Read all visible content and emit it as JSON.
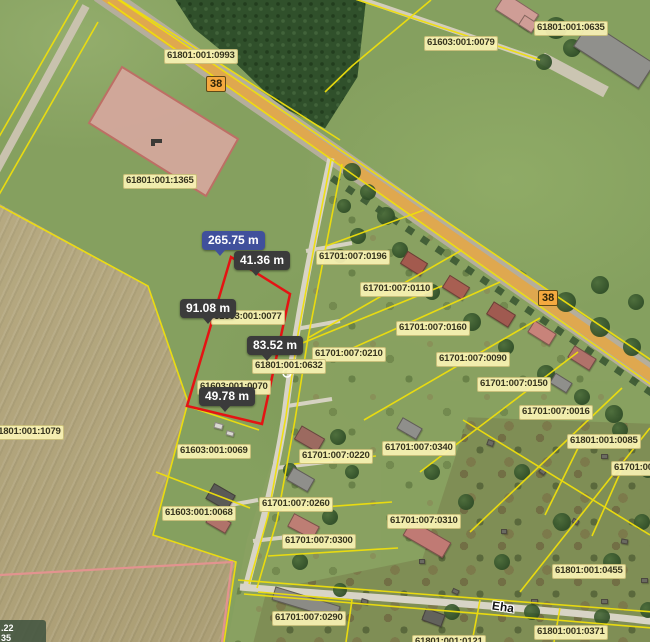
{
  "map": {
    "parcel_labels": [
      {
        "text": "61801:001:0993",
        "x": 164,
        "y": 49
      },
      {
        "text": "61603:001:0079",
        "x": 424,
        "y": 36
      },
      {
        "text": "61801:001:0635",
        "x": 534,
        "y": 21
      },
      {
        "text": "61801:001:1365",
        "x": 123,
        "y": 174
      },
      {
        "text": "61701:007:0196",
        "x": 316,
        "y": 250
      },
      {
        "text": "61701:007:0110",
        "x": 360,
        "y": 282
      },
      {
        "text": "61701:007:0160",
        "x": 396,
        "y": 321
      },
      {
        "text": "61701:007:0210",
        "x": 312,
        "y": 347
      },
      {
        "text": "61701:007:0090",
        "x": 436,
        "y": 352
      },
      {
        "text": "61701:007:0150",
        "x": 477,
        "y": 377
      },
      {
        "text": "61701:007:0016",
        "x": 519,
        "y": 405
      },
      {
        "text": "61801:001:0085",
        "x": 567,
        "y": 434
      },
      {
        "text": "61701:00",
        "x": 611,
        "y": 461
      },
      {
        "text": "61801:001:1079",
        "x": -10,
        "y": 425
      },
      {
        "text": "61603:001:0077",
        "x": 211,
        "y": 310
      },
      {
        "text": "61801:001:0632",
        "x": 252,
        "y": 359
      },
      {
        "text": "61603:001:0070",
        "x": 197,
        "y": 380
      },
      {
        "text": "61603:001:0069",
        "x": 177,
        "y": 444
      },
      {
        "text": "61603:001:0068",
        "x": 162,
        "y": 506
      },
      {
        "text": "61701:007:0220",
        "x": 299,
        "y": 449
      },
      {
        "text": "61701:007:0340",
        "x": 382,
        "y": 441
      },
      {
        "text": "61701:007:0260",
        "x": 259,
        "y": 497
      },
      {
        "text": "61701:007:0310",
        "x": 387,
        "y": 514
      },
      {
        "text": "61701:007:0300",
        "x": 282,
        "y": 534
      },
      {
        "text": "61701:007:0290",
        "x": 272,
        "y": 611
      },
      {
        "text": "61801:001:0455",
        "x": 552,
        "y": 564
      },
      {
        "text": "61801:001:0371",
        "x": 534,
        "y": 625
      },
      {
        "text": "61801:001:0121",
        "x": 412,
        "y": 635
      }
    ],
    "road_badges": [
      {
        "text": "38",
        "x": 206,
        "y": 76
      },
      {
        "text": "38",
        "x": 538,
        "y": 290
      }
    ],
    "street_label": {
      "text": "Eha"
    },
    "measurements": {
      "total": {
        "text": "265.75 m",
        "x": 202,
        "y": 231,
        "ptr": 12
      },
      "segments": [
        {
          "text": "41.36 m",
          "x": 234,
          "y": 251,
          "ptr": 16
        },
        {
          "text": "91.08 m",
          "x": 180,
          "y": 299,
          "ptr": 22
        },
        {
          "text": "83.52 m",
          "x": 247,
          "y": 336,
          "ptr": 14
        },
        {
          "text": "49.78 m",
          "x": 199,
          "y": 387,
          "ptr": 20
        }
      ]
    },
    "coordinate_readout": {
      "line1": ".22",
      "line2": "35"
    },
    "colors": {
      "selection": "#e51313",
      "measure_box": "#3b3b3b",
      "measure_total_box": "#40509c",
      "parcel_label_bg": "#faf3b4",
      "road_badge_bg": "#f5a93f",
      "road_fill": "#dfa84f",
      "cadastral_line": "#efdf0c",
      "highlight_parcel_fill": "#d9a7a0"
    },
    "decor": {
      "buildings": [
        [
          497,
          2,
          40,
          20,
          33,
          "#cf9d96"
        ],
        [
          520,
          18,
          16,
          12,
          33,
          "#cf9d96"
        ],
        [
          575,
          40,
          78,
          30,
          33,
          "#90908c"
        ],
        [
          402,
          256,
          24,
          15,
          32,
          "#a35a4e"
        ],
        [
          444,
          280,
          24,
          15,
          32,
          "#a85f52"
        ],
        [
          488,
          307,
          26,
          15,
          32,
          "#a05a50"
        ],
        [
          529,
          326,
          26,
          14,
          32,
          "#c8837a"
        ],
        [
          569,
          351,
          26,
          14,
          32,
          "#b0726a"
        ],
        [
          551,
          377,
          20,
          12,
          32,
          "#8f8f8b"
        ],
        [
          296,
          431,
          27,
          16,
          30,
          "#9c6a60"
        ],
        [
          288,
          472,
          25,
          15,
          30,
          "#8f8f8b"
        ],
        [
          289,
          519,
          29,
          15,
          28,
          "#bd7e74"
        ],
        [
          208,
          488,
          25,
          18,
          30,
          "#5a5a56"
        ],
        [
          207,
          516,
          23,
          13,
          30,
          "#b0726a"
        ],
        [
          398,
          422,
          23,
          13,
          30,
          "#8f8f8b"
        ],
        [
          404,
          530,
          46,
          18,
          30,
          "#c07a74"
        ],
        [
          272,
          596,
          68,
          14,
          17,
          "#8b8b85"
        ],
        [
          423,
          611,
          21,
          13,
          20,
          "#62625c"
        ],
        [
          487,
          440,
          7,
          6,
          20,
          "#6b6b62"
        ],
        [
          539,
          469,
          7,
          5,
          35,
          "#6b6b62"
        ],
        [
          601,
          454,
          7,
          5,
          0,
          "#6b6b62"
        ],
        [
          572,
          519,
          7,
          5,
          30,
          "#6b6b62"
        ],
        [
          621,
          539,
          7,
          5,
          10,
          "#6b6b62"
        ],
        [
          501,
          529,
          6,
          5,
          0,
          "#6b6b62"
        ],
        [
          452,
          589,
          7,
          5,
          25,
          "#6b6b62"
        ],
        [
          531,
          599,
          7,
          5,
          0,
          "#6b6b62"
        ],
        [
          361,
          599,
          7,
          5,
          15,
          "#6b6b62"
        ],
        [
          601,
          599,
          7,
          5,
          0,
          "#6b6b62"
        ],
        [
          419,
          559,
          6,
          5,
          0,
          "#6b6b62"
        ],
        [
          641,
          578,
          7,
          5,
          0,
          "#6b6b62"
        ],
        [
          214,
          423,
          9,
          6,
          15,
          "#d9d9d1"
        ],
        [
          226,
          431,
          8,
          5,
          15,
          "#d9d9d1"
        ]
      ],
      "trees": [
        [
          352,
          172,
          9
        ],
        [
          368,
          192,
          8
        ],
        [
          344,
          206,
          7
        ],
        [
          386,
          216,
          9
        ],
        [
          358,
          236,
          8
        ],
        [
          340,
          256,
          7
        ],
        [
          400,
          250,
          8
        ],
        [
          432,
          292,
          8
        ],
        [
          472,
          322,
          9
        ],
        [
          506,
          347,
          8
        ],
        [
          546,
          374,
          9
        ],
        [
          582,
          397,
          8
        ],
        [
          614,
          414,
          9
        ],
        [
          566,
          302,
          10
        ],
        [
          600,
          327,
          10
        ],
        [
          632,
          347,
          9
        ],
        [
          600,
          285,
          9
        ],
        [
          636,
          302,
          8
        ],
        [
          556,
          28,
          11
        ],
        [
          572,
          48,
          9
        ],
        [
          544,
          62,
          8
        ],
        [
          338,
          437,
          8
        ],
        [
          352,
          472,
          7
        ],
        [
          330,
          517,
          8
        ],
        [
          300,
          562,
          8
        ],
        [
          432,
          472,
          8
        ],
        [
          466,
          502,
          8
        ],
        [
          522,
          472,
          8
        ],
        [
          562,
          522,
          9
        ],
        [
          612,
          562,
          9
        ],
        [
          642,
          522,
          8
        ],
        [
          502,
          562,
          8
        ],
        [
          452,
          612,
          8
        ],
        [
          532,
          612,
          8
        ],
        [
          602,
          617,
          8
        ],
        [
          340,
          590,
          7
        ],
        [
          290,
          470,
          7
        ],
        [
          620,
          430,
          8
        ],
        [
          648,
          470,
          8
        ],
        [
          648,
          610,
          8
        ]
      ]
    }
  }
}
